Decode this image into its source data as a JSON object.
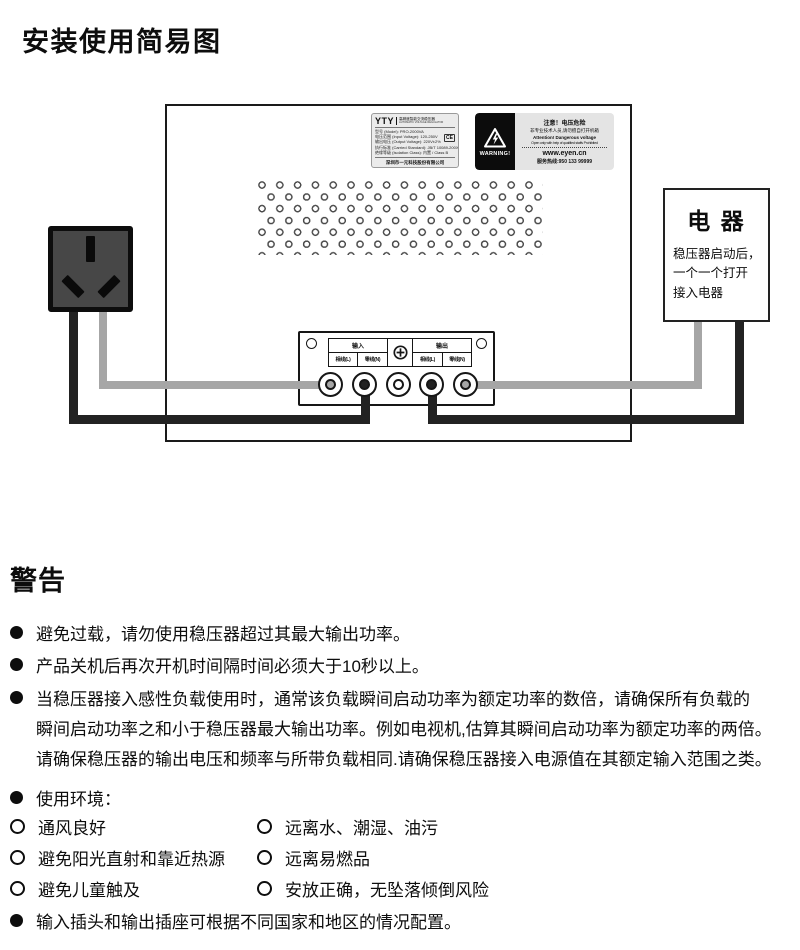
{
  "page": {
    "title": "安装使用简易图"
  },
  "device": {
    "model_label": {
      "brand": "YTY",
      "brand_desc_cn": "高精度智能交流稳压器",
      "brand_desc_en": "AUTOMATIC VOLTAGE REGULATOR",
      "info_lines": [
        "型号 (Model): PRO-2000VA",
        "电压范围 (Input Voltage): 120-250V",
        "输出电压 (Output Voltage): 220V±2%",
        "执行标准 (Carried Standard): JB/T 10089-200X",
        "绝缘等级 (Isolation Class): 内置 / Class B"
      ],
      "cert_mark": "CE",
      "company": "深圳市一元科技股份有限公司"
    },
    "warning_label": {
      "warning_text": "WARNING!",
      "title_cn": "注意！电压危险",
      "sub_cn": "非专业技术人员,请勿擅自打开机箱",
      "title_en": "Attention! Dangerous voltage",
      "sub_en": "Open only with help of qualified staffs Prohibited",
      "website": "www.eyen.cn",
      "hotline": "服务热线:950 133 99999"
    },
    "terminal_panel": {
      "input_label": "输入",
      "output_label": "输出",
      "input_cols": [
        "相线(L)",
        "零线(N)"
      ],
      "output_cols": [
        "相线(L)",
        "零线(N)"
      ]
    }
  },
  "appliance": {
    "title": "电 器",
    "lines": [
      "稳压器启动后，",
      "一个一个打开",
      "接入电器"
    ]
  },
  "warnings": {
    "heading": "警告",
    "bullet1": "避免过载，请勿使用稳压器超过其最大输出功率。",
    "bullet2": "产品关机后再次开机时间隔时间必须大于10秒以上。",
    "bullet3_line1": "当稳压器接入感性负载使用时，通常该负载瞬间启动功率为额定功率的数倍，请确保所有负载的",
    "bullet3_line2": "瞬间启动功率之和小于稳压器最大输出功率。例如电视机,估算其瞬间启动功率为额定功率的两倍。",
    "bullet3_line3": "请确保稳压器的输出电压和频率与所带负载相同.请确保稳压器接入电源值在其额定输入范围之类。",
    "bullet4": "使用环境：",
    "env_items": [
      {
        "left": "通风良好",
        "right": "远离水、潮湿、油污"
      },
      {
        "left": "避免阳光直射和靠近热源",
        "right": "远离易燃品"
      },
      {
        "left": "避免儿童触及",
        "right": "安放正确，无坠落倾倒风险"
      }
    ],
    "bullet5": "输入插头和输出插座可根据不同国家和地区的情况配置。"
  },
  "colors": {
    "wire_gray": "#a6a6a6",
    "wire_black": "#222222",
    "label_bg": "#e4e4e4",
    "warning_bg": "#0c0c0c"
  }
}
